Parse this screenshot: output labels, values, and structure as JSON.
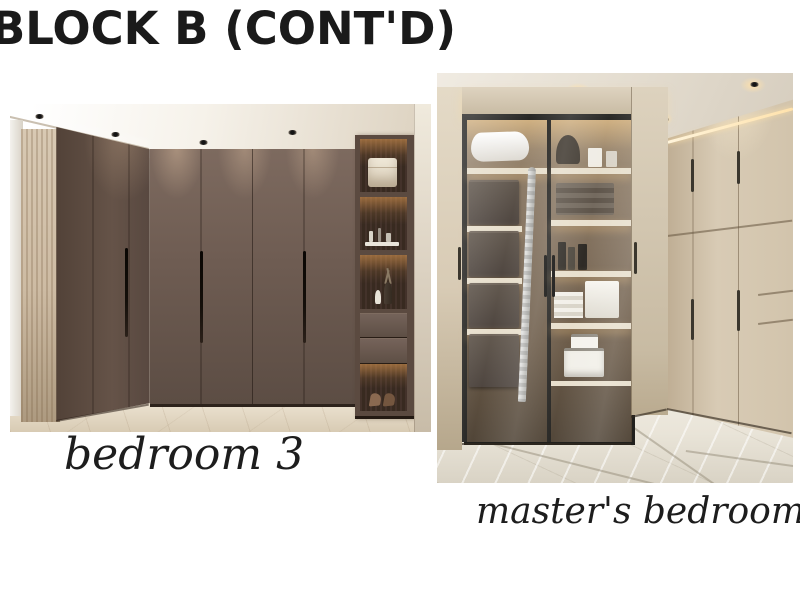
{
  "page": {
    "title": "BLOCK B (CONT'D)"
  },
  "photos": [
    {
      "id": "bedroom-3",
      "caption": "bedroom 3",
      "alt": "Corner wardrobe in dark taupe matte panels with long black recessed handles, light wood end pillar, open display tower with warm-lit shelves holding a storage box, perfumes, vases, two drawers and high-heel shoes, white ceiling with recessed spotlights, beige stone floor"
    },
    {
      "id": "masters-bedroom",
      "caption": "master's bedroom",
      "alt": "Beige floor-to-ceiling fitted wardrobes with two black-framed smoked glass doors revealing lit shelves with a pillow, pull-out fabric drawers, an ironing board, folded towels, bottles, a white box, folded linens and a step stool, LED cove ceiling with spotlights, glossy marble tile floor"
    }
  ],
  "palette": {
    "page_bg": "#ffffff",
    "ink": "#1a1a1a",
    "caption_ink": "#1d1d1d",
    "b3_door": "#6e5c52",
    "b3_door_dark": "#584840",
    "b3_wood": "#cdbba3",
    "b3_floor": "#e9dfcd",
    "b3_ceiling": "#f6f2ea",
    "b3_interior": "#3a2b20",
    "b3_glow": "#e8a055",
    "b3_handle": "#140f0a",
    "mb_ceiling": "#e5ded1",
    "mb_panel": "#d8cbb5",
    "mb_frame": "#21201d",
    "mb_led": "#ffe2ac",
    "mb_interior": "#7e6c58",
    "mb_shelf": "#e7decb",
    "mb_floor": "#e9e4d8",
    "mb_handle": "#3b372e"
  }
}
